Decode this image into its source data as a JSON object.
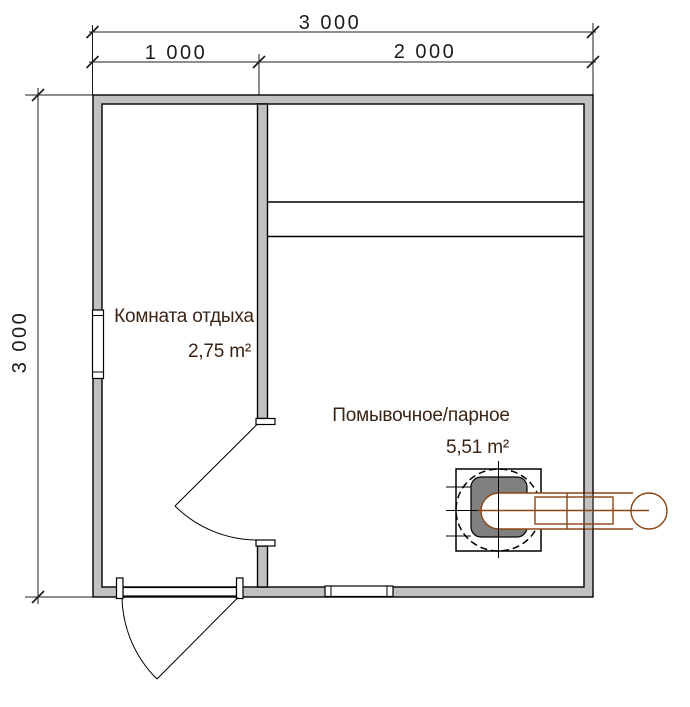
{
  "dimensions": {
    "top_total": "3 000",
    "top_segment_left": "1 000",
    "top_segment_right": "2 000",
    "left_total": "3 000"
  },
  "rooms": [
    {
      "name": "Комната отдыха",
      "area": "2,75 m²"
    },
    {
      "name": "Помывочное/парное",
      "area": "5,51 m²"
    }
  ],
  "colors": {
    "wall_fill": "#c1c1c1",
    "stove_fill": "#808080",
    "pipe_stroke": "#8b4513",
    "room_label_text": "#3b2414",
    "dimension_text": "#1c1c1c"
  }
}
